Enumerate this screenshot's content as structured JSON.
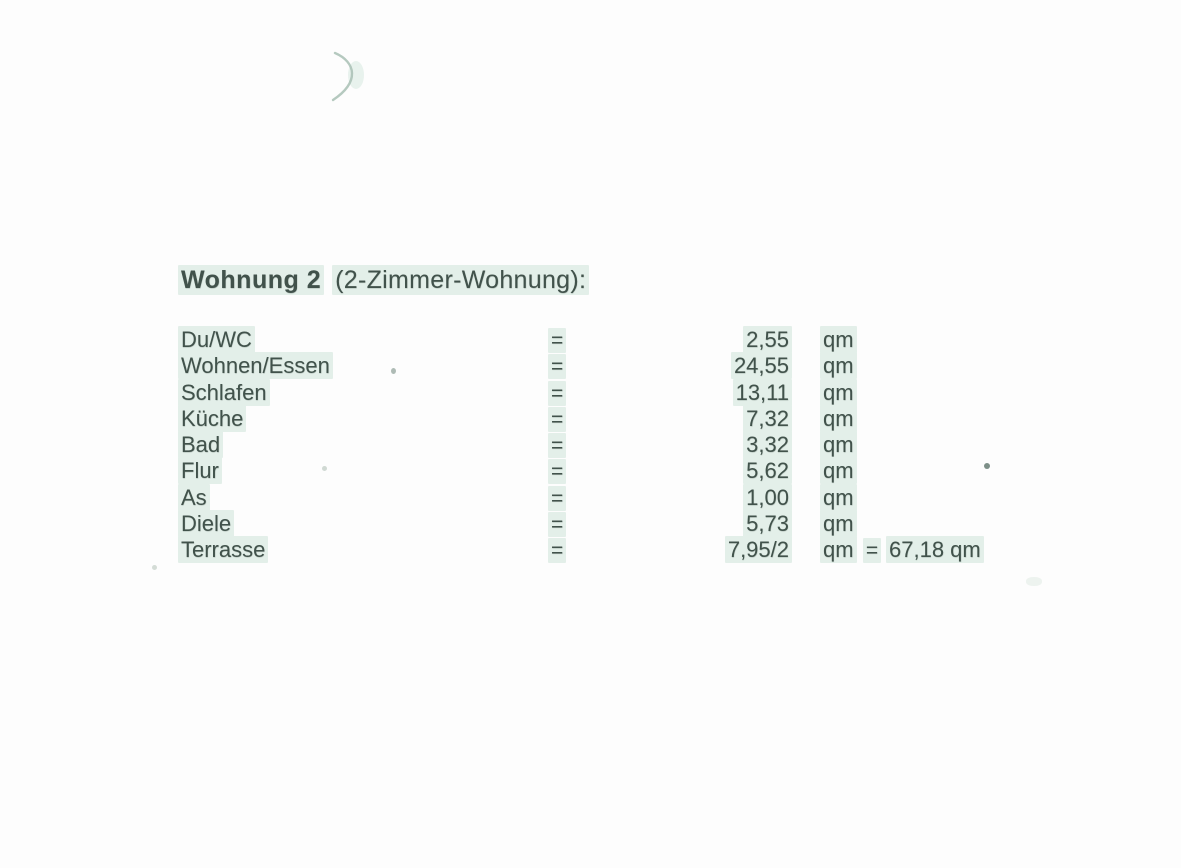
{
  "page": {
    "background_color": "#fdfdfd",
    "ink_color": "#41524b",
    "highlight_color": "#e3efe9",
    "artifact_color": "#a8bfb4"
  },
  "document": {
    "title": {
      "bold": "Wohnung 2",
      "rest": "(2-Zimmer-Wohnung):"
    },
    "table": {
      "rows": [
        {
          "label": "Du/WC",
          "eq": "=",
          "value": "2,55",
          "unit": "qm",
          "eq2": "",
          "total": ""
        },
        {
          "label": "Wohnen/Essen",
          "eq": "=",
          "value": "24,55",
          "unit": "qm",
          "eq2": "",
          "total": ""
        },
        {
          "label": "Schlafen",
          "eq": "=",
          "value": "13,11",
          "unit": "qm",
          "eq2": "",
          "total": ""
        },
        {
          "label": "Küche",
          "eq": "=",
          "value": "7,32",
          "unit": "qm",
          "eq2": "",
          "total": ""
        },
        {
          "label": "Bad",
          "eq": "=",
          "value": "3,32",
          "unit": "qm",
          "eq2": "",
          "total": ""
        },
        {
          "label": "Flur",
          "eq": "=",
          "value": "5,62",
          "unit": "qm",
          "eq2": "",
          "total": ""
        },
        {
          "label": "As",
          "eq": "=",
          "value": "1,00",
          "unit": "qm",
          "eq2": "",
          "total": ""
        },
        {
          "label": "Diele",
          "eq": "=",
          "value": "5,73",
          "unit": "qm",
          "eq2": "",
          "total": ""
        },
        {
          "label": "Terrasse",
          "eq": "=",
          "value": "7,95/2",
          "unit": "qm",
          "eq2": "=",
          "total": "67,18 qm"
        }
      ]
    }
  }
}
